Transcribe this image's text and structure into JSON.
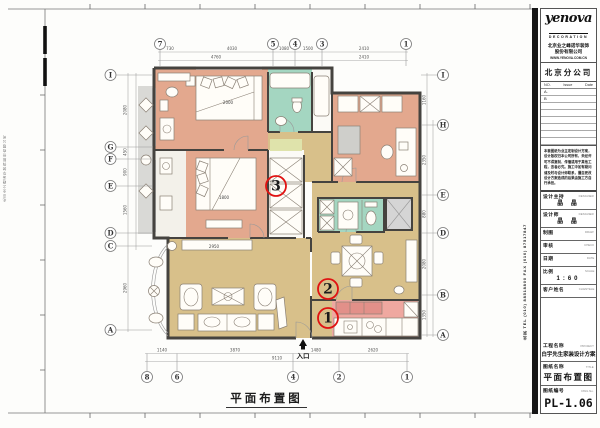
{
  "sheet": {
    "drawing_title_caption": "平面布置图",
    "entrance_label": "入口",
    "edge_note": "北京业之峰诺华装饰股份有限公司",
    "contact_vertical": "北京 TEL (010) 88518800 FAX (010) 87517847"
  },
  "title_block": {
    "logo_text": "yenova",
    "logo_sub": "DECORATION",
    "company_lines": [
      "北京业之峰诺华装饰",
      "股份有限公司"
    ],
    "company_contact": "WWW.YENOVA.COM.CN",
    "branch": "北京分公司",
    "revision": {
      "headers": [
        "NO.",
        "Issue",
        "Date"
      ],
      "rows": [
        "A.",
        "B"
      ],
      "blank_row_count": 6
    },
    "disclaimer_lines": [
      "本套图纸为业主定制设计方案，",
      "设计版权归本公司所有，未经许",
      "可不得复制、传播或用于其他工",
      "程，违者必究。施工中如有疑问",
      "请及时与设计师联系，擅自更改",
      "设计方案造成的后果由施工方自",
      "行承担。"
    ],
    "fields": [
      {
        "label": "设计主持",
        "en": "DESIGNER",
        "value": "晶 晶"
      },
      {
        "label": "设计师",
        "en": "DESIGNER",
        "value": "晶 晶"
      },
      {
        "label": "制图",
        "en": "DRAW",
        "value": ""
      },
      {
        "label": "审核",
        "en": "CHECK",
        "value": ""
      },
      {
        "label": "日期",
        "en": "DATE",
        "value": ""
      },
      {
        "label": "比例",
        "en": "SCALE",
        "value": "1:60"
      },
      {
        "label": "客户姓名",
        "en": "CLIENTELE",
        "value": ""
      }
    ],
    "project": {
      "label": "工程名称",
      "en": "PROJECT",
      "value": "白宇先生家装设计方案"
    },
    "drawing_title": {
      "label": "图纸名称",
      "en": "TITLE",
      "value": "平面布置图"
    },
    "drawing_no": {
      "label": "图纸编号",
      "en": "DWG No.",
      "value": "PL-1.06"
    }
  },
  "plan": {
    "colors": {
      "bedroom": "#e3a88e",
      "bath": "#a4d6c1",
      "living": "#d8c08a",
      "kitchen": "#efa8a0",
      "shaft": "#d5d5d5",
      "balcony": "#d9d9d6",
      "wall": "#45433f",
      "marker": "#e01212"
    },
    "markers": [
      {
        "num": "3",
        "x": 276,
        "y": 186
      },
      {
        "num": "2",
        "x": 328,
        "y": 289
      },
      {
        "num": "1",
        "x": 328,
        "y": 318
      }
    ],
    "grid": {
      "top": [
        {
          "label": "7",
          "x": 160
        },
        {
          "label": "5",
          "x": 273
        },
        {
          "label": "4",
          "x": 295
        },
        {
          "label": "3",
          "x": 322
        },
        {
          "label": "1",
          "x": 406
        }
      ],
      "bottom": [
        {
          "label": "8",
          "x": 147
        },
        {
          "label": "6",
          "x": 177
        },
        {
          "label": "4",
          "x": 293
        },
        {
          "label": "2",
          "x": 339
        },
        {
          "label": "1",
          "x": 407
        }
      ],
      "left": [
        {
          "label": "I",
          "y": 75
        },
        {
          "label": "G",
          "y": 147
        },
        {
          "label": "F",
          "y": 159
        },
        {
          "label": "E",
          "y": 186
        },
        {
          "label": "D",
          "y": 233
        },
        {
          "label": "C",
          "y": 246
        },
        {
          "label": "A",
          "y": 330
        }
      ],
      "right": [
        {
          "label": "I",
          "y": 75
        },
        {
          "label": "H",
          "y": 125
        },
        {
          "label": "E",
          "y": 195
        },
        {
          "label": "D",
          "y": 233
        },
        {
          "label": "B",
          "y": 295
        },
        {
          "label": "A",
          "y": 335
        }
      ]
    },
    "dims": {
      "top": [
        {
          "text": "730",
          "x": 170,
          "y": 50
        },
        {
          "text": "4030",
          "x": 232,
          "y": 50
        },
        {
          "text": "1080",
          "x": 284,
          "y": 50
        },
        {
          "text": "1500",
          "x": 308,
          "y": 50
        },
        {
          "text": "2410",
          "x": 364,
          "y": 50
        },
        {
          "text": "4760",
          "x": 216,
          "y": 58.5
        },
        {
          "text": "2410",
          "x": 364,
          "y": 58.5
        }
      ],
      "bottom": [
        {
          "text": "1140",
          "x": 162,
          "y": 351.5
        },
        {
          "text": "3870",
          "x": 235,
          "y": 351.5
        },
        {
          "text": "1480",
          "x": 316,
          "y": 351.5
        },
        {
          "text": "2620",
          "x": 373,
          "y": 351.5
        },
        {
          "text": "9110",
          "x": 277,
          "y": 359.5
        }
      ],
      "left": [
        {
          "text": "2080",
          "y": 110
        },
        {
          "text": "450",
          "y": 152
        },
        {
          "text": "900",
          "y": 172
        },
        {
          "text": "1560",
          "y": 210
        },
        {
          "text": "2960",
          "y": 288
        }
      ],
      "right": [
        {
          "text": "1160",
          "y": 100
        },
        {
          "text": "2350",
          "y": 160
        },
        {
          "text": "880",
          "y": 214
        },
        {
          "text": "2080",
          "y": 264
        },
        {
          "text": "1350",
          "y": 315
        }
      ]
    },
    "furniture_labels": [
      {
        "text": "2000",
        "x": 228,
        "y": 104
      },
      {
        "text": "1800",
        "x": 224,
        "y": 199
      },
      {
        "text": "2950",
        "x": 214,
        "y": 248
      }
    ]
  }
}
